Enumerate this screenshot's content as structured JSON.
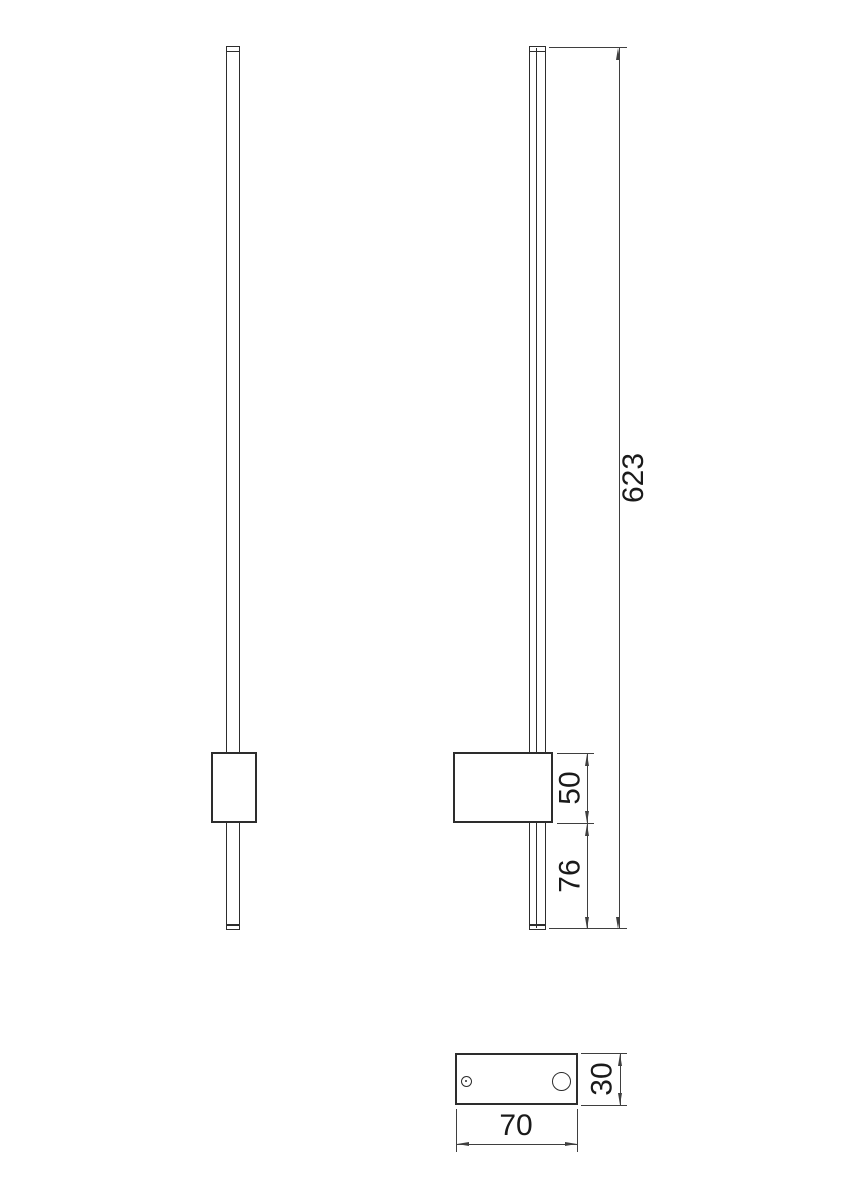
{
  "drawing": {
    "dimensions": {
      "overall_height": {
        "value": "623"
      },
      "housing_height": {
        "value": "50"
      },
      "housing_to_end": {
        "value": "76"
      },
      "base_width": {
        "value": "70"
      },
      "base_depth": {
        "value": "30"
      }
    },
    "colors": {
      "line": "#2d2d2d",
      "dim": "#3f3f3f",
      "text": "#1a1a1a",
      "bg": "#ffffff"
    }
  }
}
